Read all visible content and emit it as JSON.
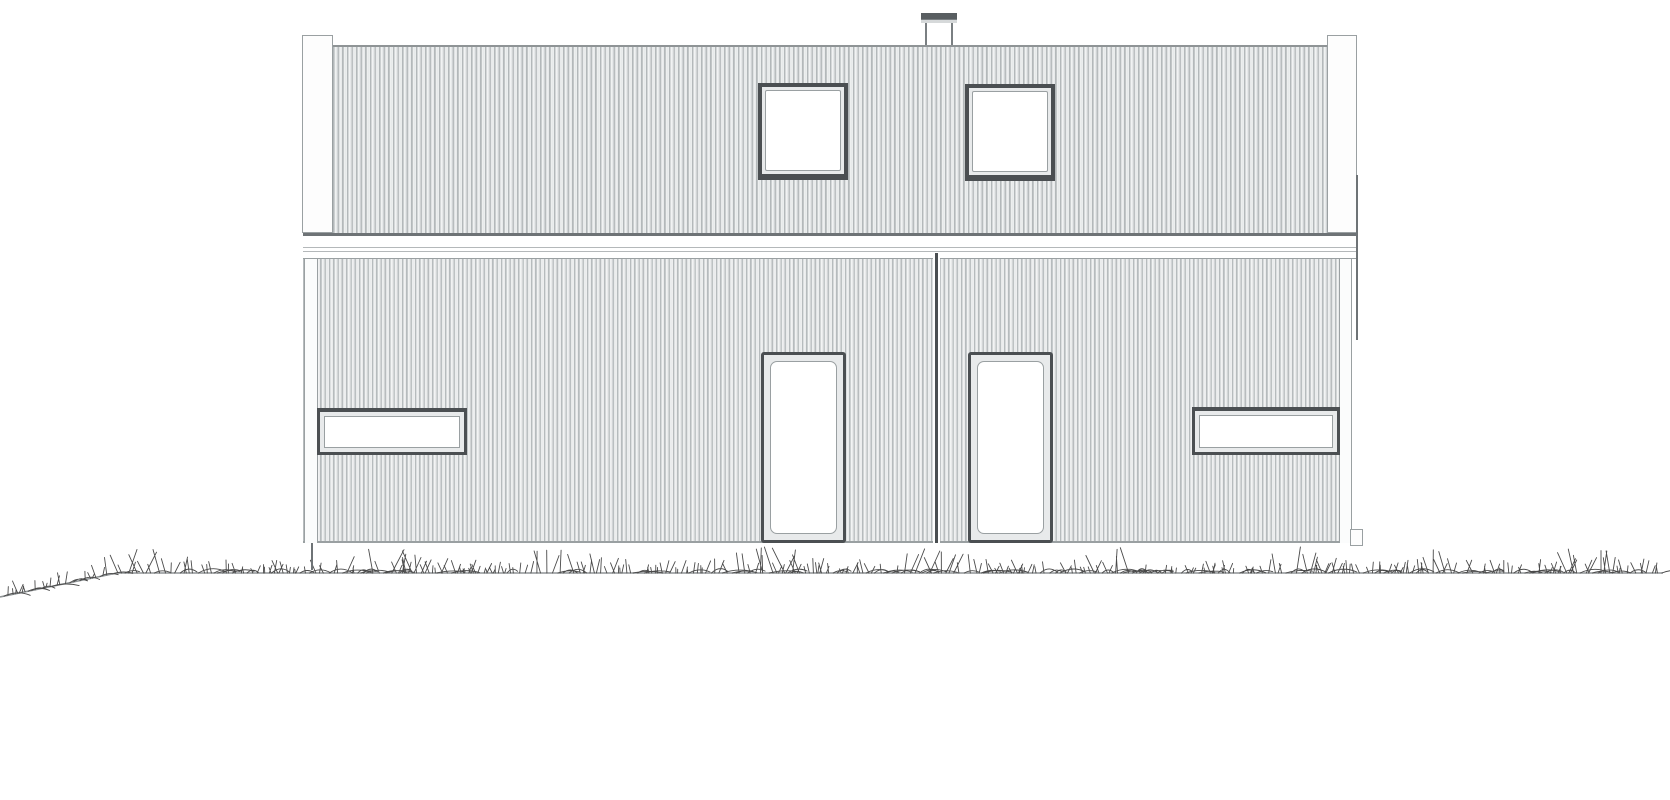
{
  "drawing": {
    "kind": "architectural-elevation",
    "subject": "house-front-elevation-duplex",
    "ink_color": "#4b4f52",
    "light_line_color": "#9aa0a2",
    "background_color": "#ffffff"
  },
  "scene": {
    "elements": [
      {
        "name": "corner-post-left",
        "type": "post",
        "rect": [
          302,
          35,
          31,
          198
        ]
      },
      {
        "name": "corner-post-right",
        "type": "post",
        "rect": [
          1327,
          35,
          30,
          198
        ]
      },
      {
        "name": "chimney-body",
        "type": "chimney-body",
        "rect": [
          925,
          21,
          28,
          26
        ]
      },
      {
        "name": "chimney-cap",
        "type": "chimney-cap",
        "rect": [
          921,
          13,
          36,
          10
        ]
      },
      {
        "name": "upper-floor-cladding",
        "type": "clad-upper",
        "rect": [
          333,
          45,
          994,
          188
        ]
      },
      {
        "name": "fascia-band",
        "type": "band",
        "rect": [
          303,
          233,
          1054,
          26
        ]
      },
      {
        "name": "lower-floor-cladding",
        "type": "clad-lower",
        "rect": [
          303,
          259,
          1049,
          284
        ]
      },
      {
        "name": "downpipe-left",
        "type": "pipe",
        "rect": [
          304,
          259,
          14,
          284
        ]
      },
      {
        "name": "downpipe-right",
        "type": "pipe",
        "rect": [
          1339,
          259,
          13,
          284
        ]
      },
      {
        "name": "roof-edge-line-right",
        "type": "edge-line",
        "rect": [
          1356,
          175,
          2,
          165
        ]
      },
      {
        "name": "party-wall-divider",
        "type": "divider",
        "rect": [
          933,
          253,
          7,
          290
        ]
      },
      {
        "name": "upper-window-left",
        "type": "win-sq",
        "rect": [
          758,
          83,
          90,
          95
        ]
      },
      {
        "name": "upper-window-right",
        "type": "win-sq",
        "rect": [
          965,
          84,
          90,
          95
        ]
      },
      {
        "name": "door-left",
        "type": "door",
        "rect": [
          761,
          352,
          85,
          191
        ]
      },
      {
        "name": "door-right",
        "type": "door",
        "rect": [
          968,
          352,
          85,
          191
        ]
      },
      {
        "name": "strip-window-left",
        "type": "win-strip",
        "rect": [
          317,
          408,
          150,
          47
        ]
      },
      {
        "name": "strip-window-right",
        "type": "win-strip",
        "rect": [
          1192,
          407,
          148,
          48
        ]
      },
      {
        "name": "downpipe-shoe-left",
        "type": "edge-line",
        "rect": [
          311,
          543,
          2,
          27
        ]
      },
      {
        "name": "downpipe-shoe-right",
        "type": "post",
        "rect": [
          1350,
          529,
          13,
          17
        ]
      }
    ],
    "grass": {
      "seed": 1337,
      "x_start": 4,
      "x_end": 1663,
      "baseline_points": [
        [
          0,
          597
        ],
        [
          117,
          573
        ],
        [
          1663,
          573
        ]
      ],
      "cluster_centers": [
        140,
        390,
        560,
        770,
        935,
        1130,
        1290,
        1445,
        1590
      ],
      "blade_color": "#4a4a4a",
      "ground_line_color": "#8f9496"
    }
  }
}
